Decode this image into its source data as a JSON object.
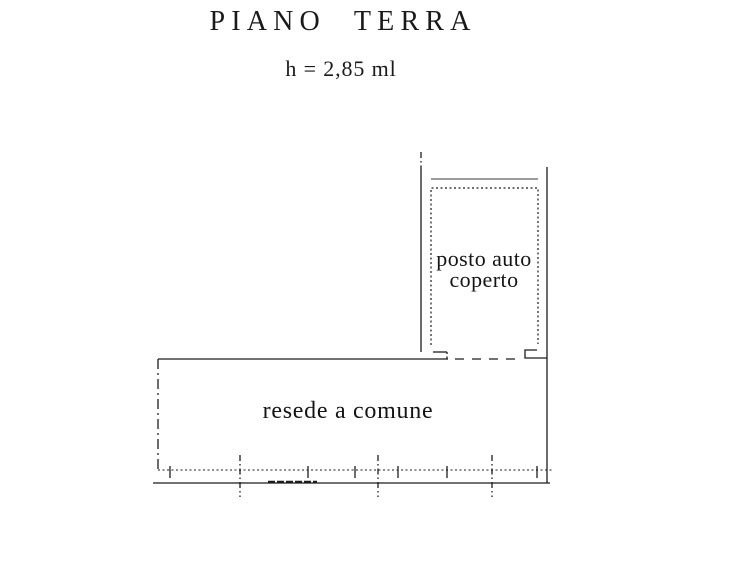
{
  "header": {
    "title": "PIANO TERRA",
    "height_note": "h = 2,85 ml"
  },
  "floor_plan": {
    "areas": {
      "carport": {
        "label_line1": "posto auto",
        "label_line2": "coperto"
      },
      "courtyard": {
        "label": "resede a comune"
      }
    },
    "colors": {
      "line": "#1c1c1c",
      "muted_line": "#9b9b9b",
      "background": "#ffffff"
    }
  }
}
